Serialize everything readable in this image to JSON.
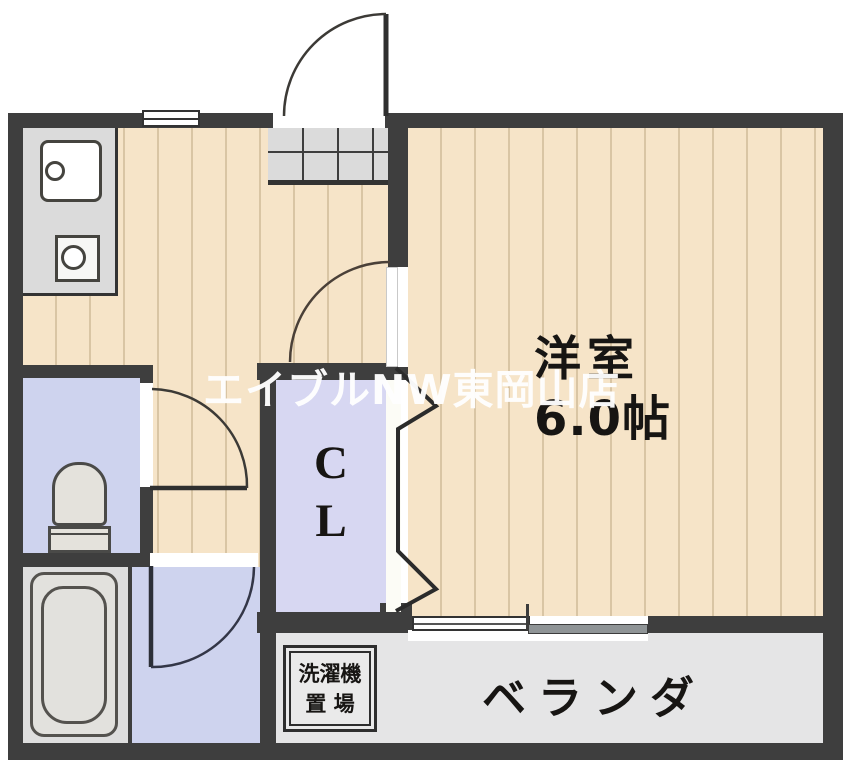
{
  "plan": {
    "watermark": "エイブルNW東岡山店",
    "rooms": {
      "main_room": {
        "name": "洋室",
        "size": "6.0帖"
      },
      "closet": {
        "letter1": "C",
        "letter2": "L"
      },
      "veranda": {
        "label": "ベランダ"
      },
      "laundry": {
        "line1": "洗濯機",
        "line2": "置 場"
      }
    },
    "colors": {
      "wall": "#3e3e3e",
      "wood_floor": "#f6e4c8",
      "tile_floor": "#ced3ee",
      "closet_floor": "#d7d7f2",
      "service_gray": "#dbdbdb",
      "veranda_gray": "#e5e5e6",
      "watermark_text": "#ffffff",
      "label_text": "#171513"
    }
  }
}
